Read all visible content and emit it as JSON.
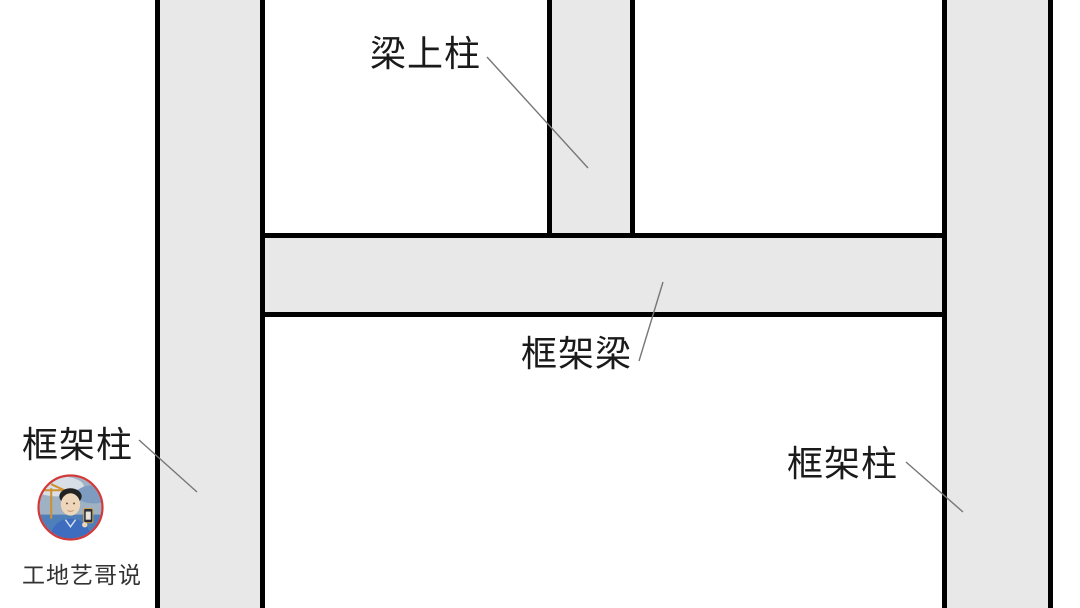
{
  "diagram": {
    "title_hint": "frame structure annotation diagram",
    "labels": {
      "beam_top_column": "梁上柱",
      "frame_beam": "框架梁",
      "frame_column_left": "框架柱",
      "frame_column_right": "框架柱"
    },
    "watermark": {
      "text": "工地艺哥说"
    },
    "colors": {
      "background": "#ffffff",
      "member_fill": "#e8e8e8",
      "member_outline": "#000000",
      "leader_line": "#777777",
      "label_text": "#1a1a1a",
      "watermark_text": "#333333",
      "avatar_ring": "#d23a3a"
    }
  }
}
